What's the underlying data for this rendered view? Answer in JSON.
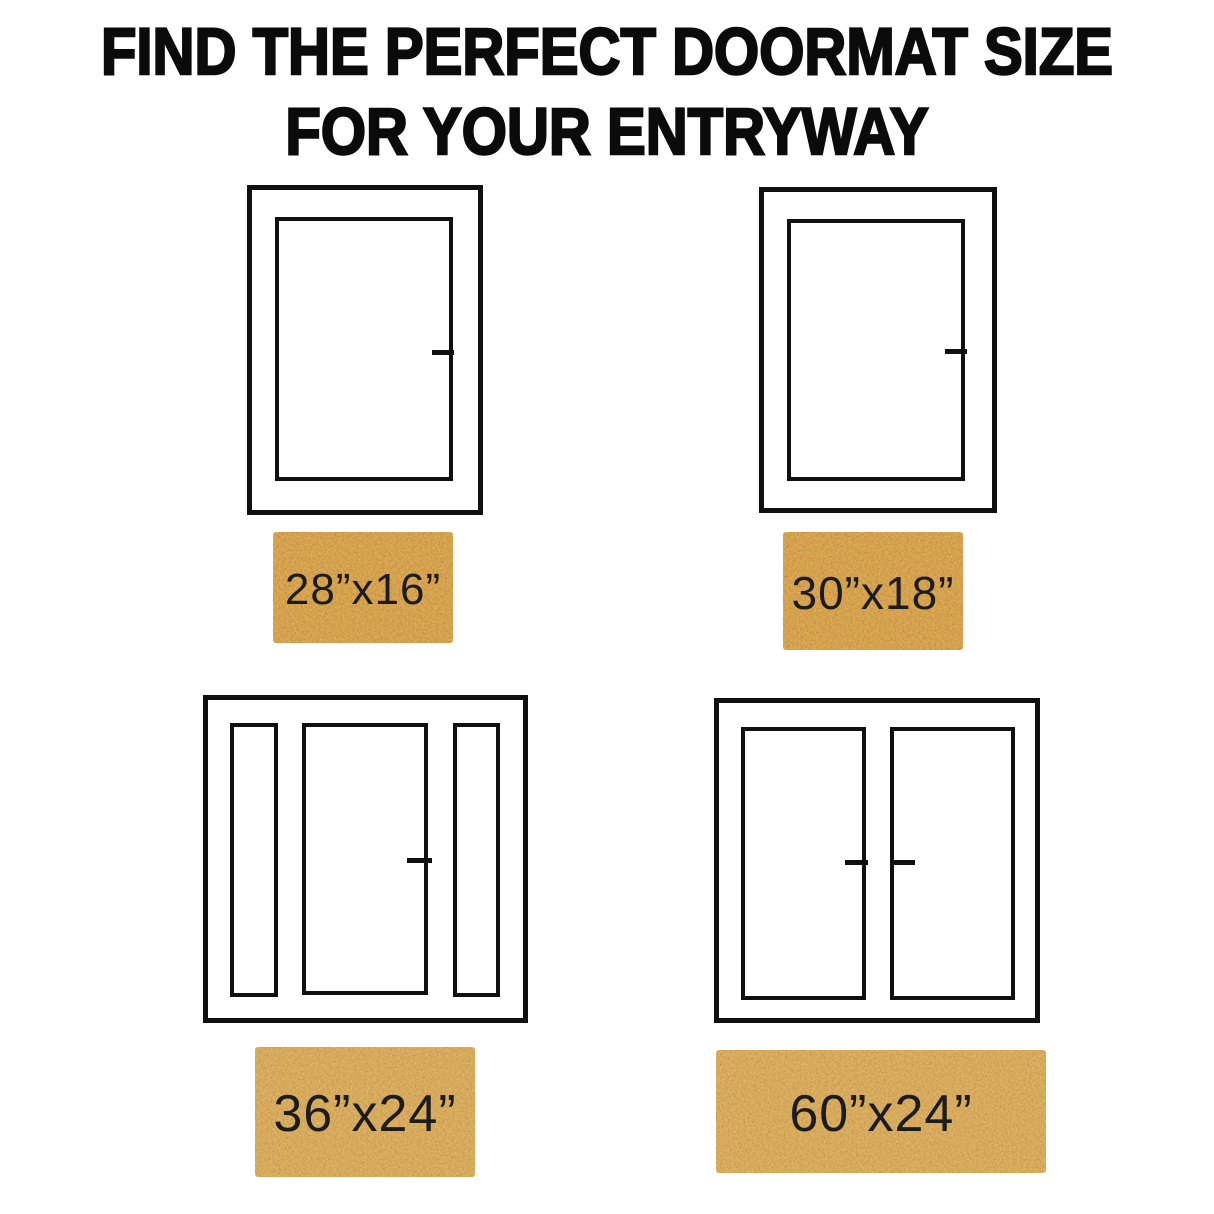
{
  "title": {
    "line1": "FIND THE PERFECT DOORMAT SIZE",
    "line2": "FOR YOUR ENTRYWAY"
  },
  "colors": {
    "background": "#ffffff",
    "title_text": "#0b0b0b",
    "door_outline": "#101010",
    "doormat_coir": "#c6823e",
    "doormat_coir_light": "#c98d4a",
    "doormat_label_text": "#1c1c1c"
  },
  "scenarios": [
    {
      "door_type": "single-door",
      "mat_label": "28”x16”"
    },
    {
      "door_type": "single-door",
      "mat_label": "30”x18”"
    },
    {
      "door_type": "door-with-sidelights",
      "mat_label": "36”x24”"
    },
    {
      "door_type": "double-door",
      "mat_label": "60”x24”"
    }
  ]
}
